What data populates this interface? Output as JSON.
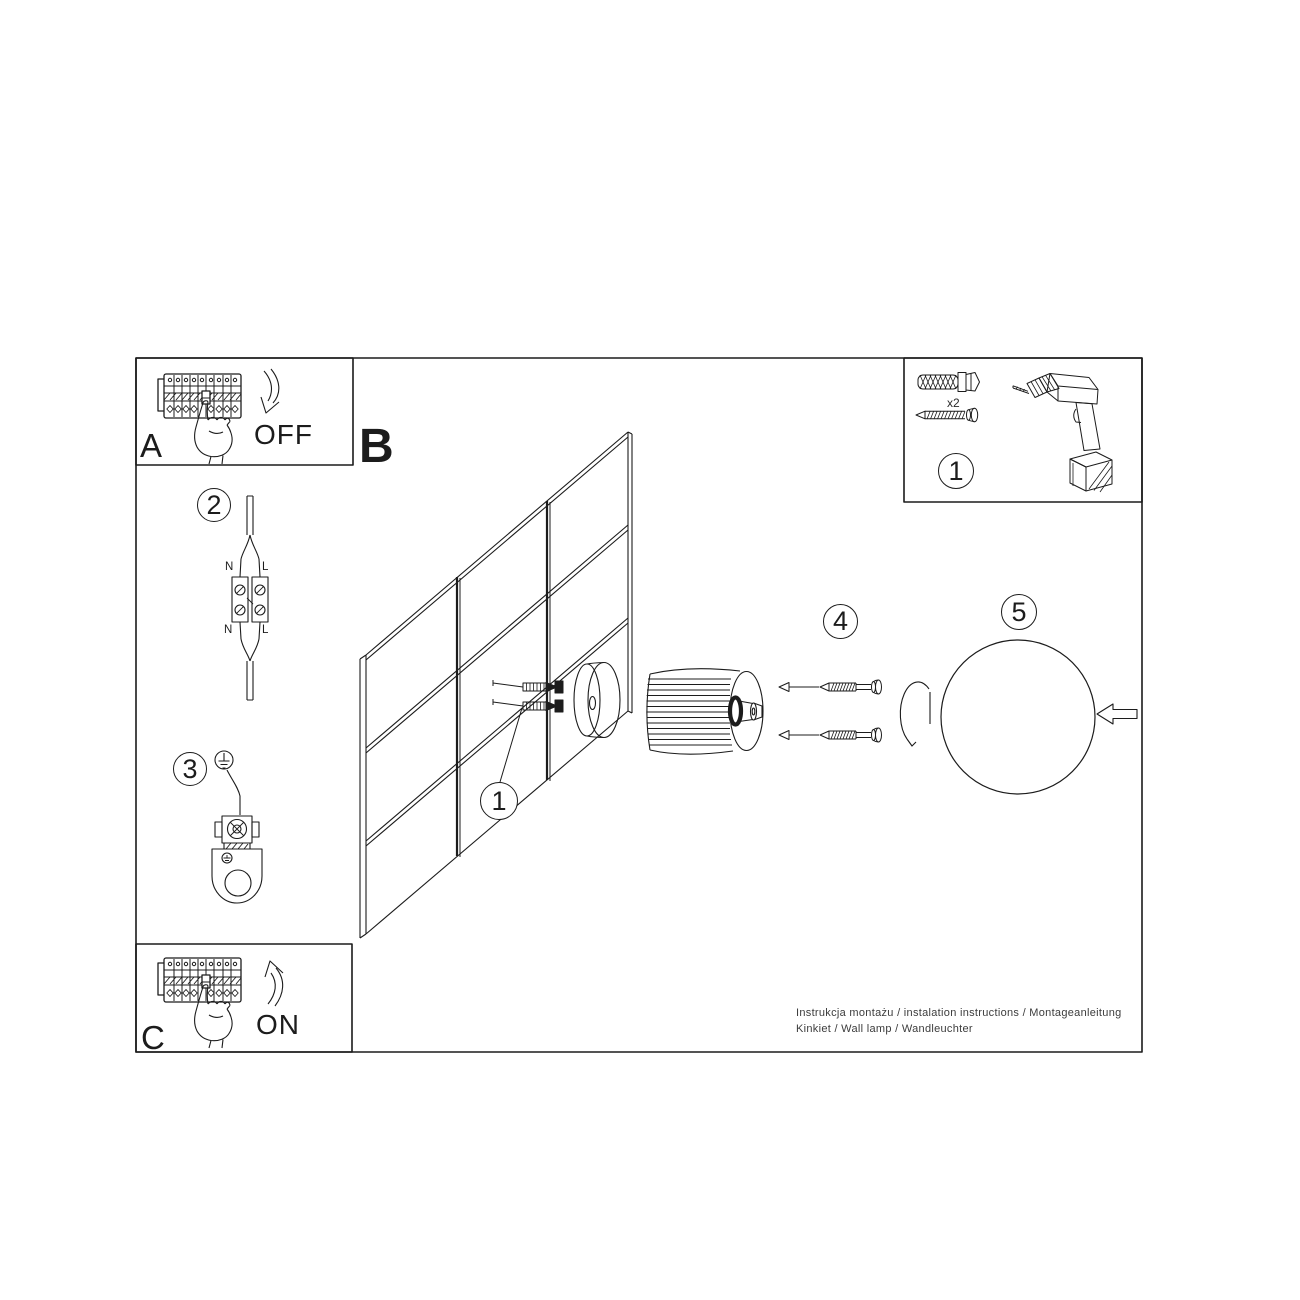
{
  "colors": {
    "line": "#1c1c1c",
    "background": "#ffffff",
    "footer_text": "#3c3c3c"
  },
  "section_b": {
    "label": "B"
  },
  "panel_a": {
    "label": "A",
    "state": "OFF"
  },
  "panel_c": {
    "label": "C",
    "state": "ON"
  },
  "tools_panel": {
    "step": "1",
    "quantity": "x2"
  },
  "steps": {
    "mount": "1",
    "connector": "2",
    "ground": "3",
    "screws": "4",
    "shade": "5"
  },
  "connector_labels": {
    "top_n": "N",
    "top_l": "L",
    "bottom_n": "N",
    "bottom_l": "L"
  },
  "footer": {
    "line1": "Instrukcja montażu / instalation instructions / Montageanleitung",
    "line2": "Kinkiet / Wall lamp / Wandleuchter"
  }
}
